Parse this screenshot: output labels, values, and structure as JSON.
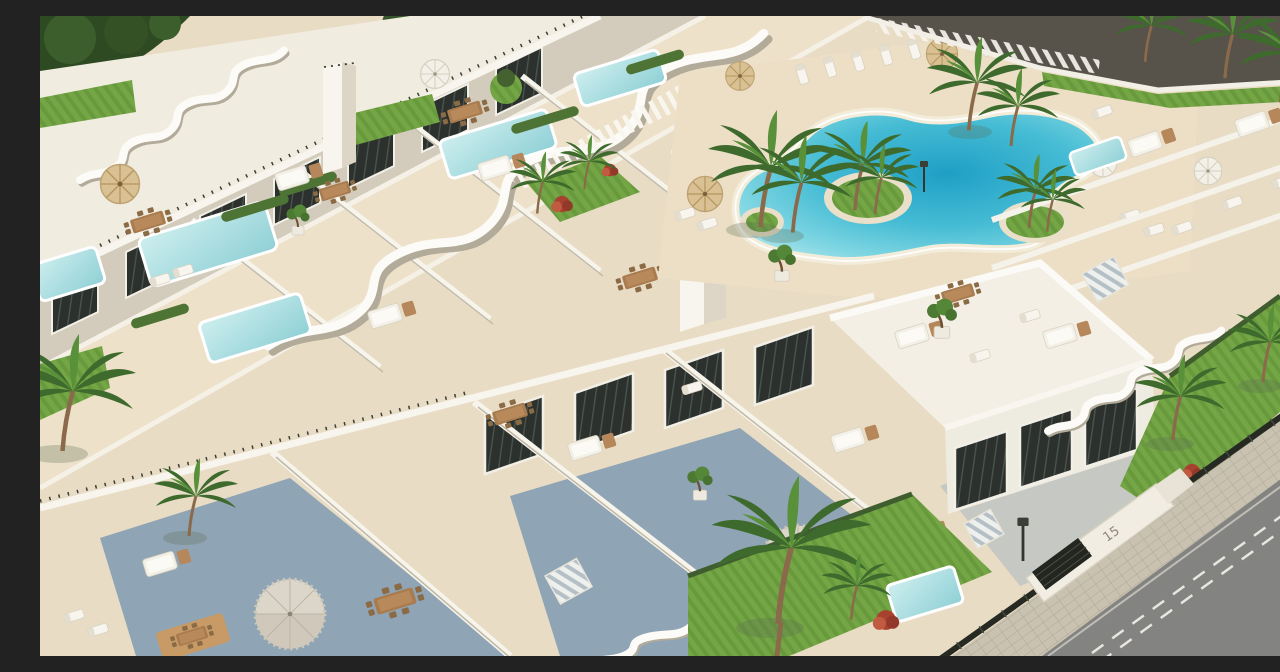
{
  "meta": {
    "description": "Aerial 3D architectural rendering of a modern white Mediterranean apartment complex: terraced blocks with wavy parapets, rooftop lounges, private plunge pools, a freeform turquoise lagoon pool with palm islands, lawns, palm trees, and a perimeter street with sidewalk and fence."
  },
  "signage": {
    "house_number": "15"
  },
  "street": {
    "lane_marking": "white-dashed-center-line"
  },
  "palette": {
    "wall_white": "#f6f3ec",
    "wall_shade": "#d9d2c2",
    "deck_cream": "#ecdfc6",
    "deck_shadow": "#8fa4b4",
    "glass_dark": "#2c312d",
    "lagoon_deep": "#1f9fc6",
    "lagoon_mid": "#5ec9db",
    "lagoon_edge": "#c3ebf0",
    "plunge_pool": "#9ed8da",
    "lawn_green": "#74a646",
    "palm_green": "#3e6b2d",
    "wood_tan": "#a97c4f",
    "straw": "#d9c193",
    "road_asphalt": "#838381",
    "sidewalk_paver": "#c9c2b1",
    "fence_dark": "#262a22",
    "red_shrub": "#a8422f"
  },
  "scene": {
    "elements": [
      "lagoon-pool",
      "pool-islands",
      "private-plunge-pools",
      "rooftop-terraces",
      "wavy-parapets",
      "palm-trees",
      "sun-loungers",
      "parasols",
      "fringed-umbrellas",
      "outdoor-sofas",
      "dining-sets",
      "bonsai-planters",
      "lawns",
      "staircases",
      "pergola-slats",
      "stair-towers",
      "street",
      "sidewalk",
      "perimeter-fence",
      "entrance-gate",
      "street-lamps"
    ]
  }
}
